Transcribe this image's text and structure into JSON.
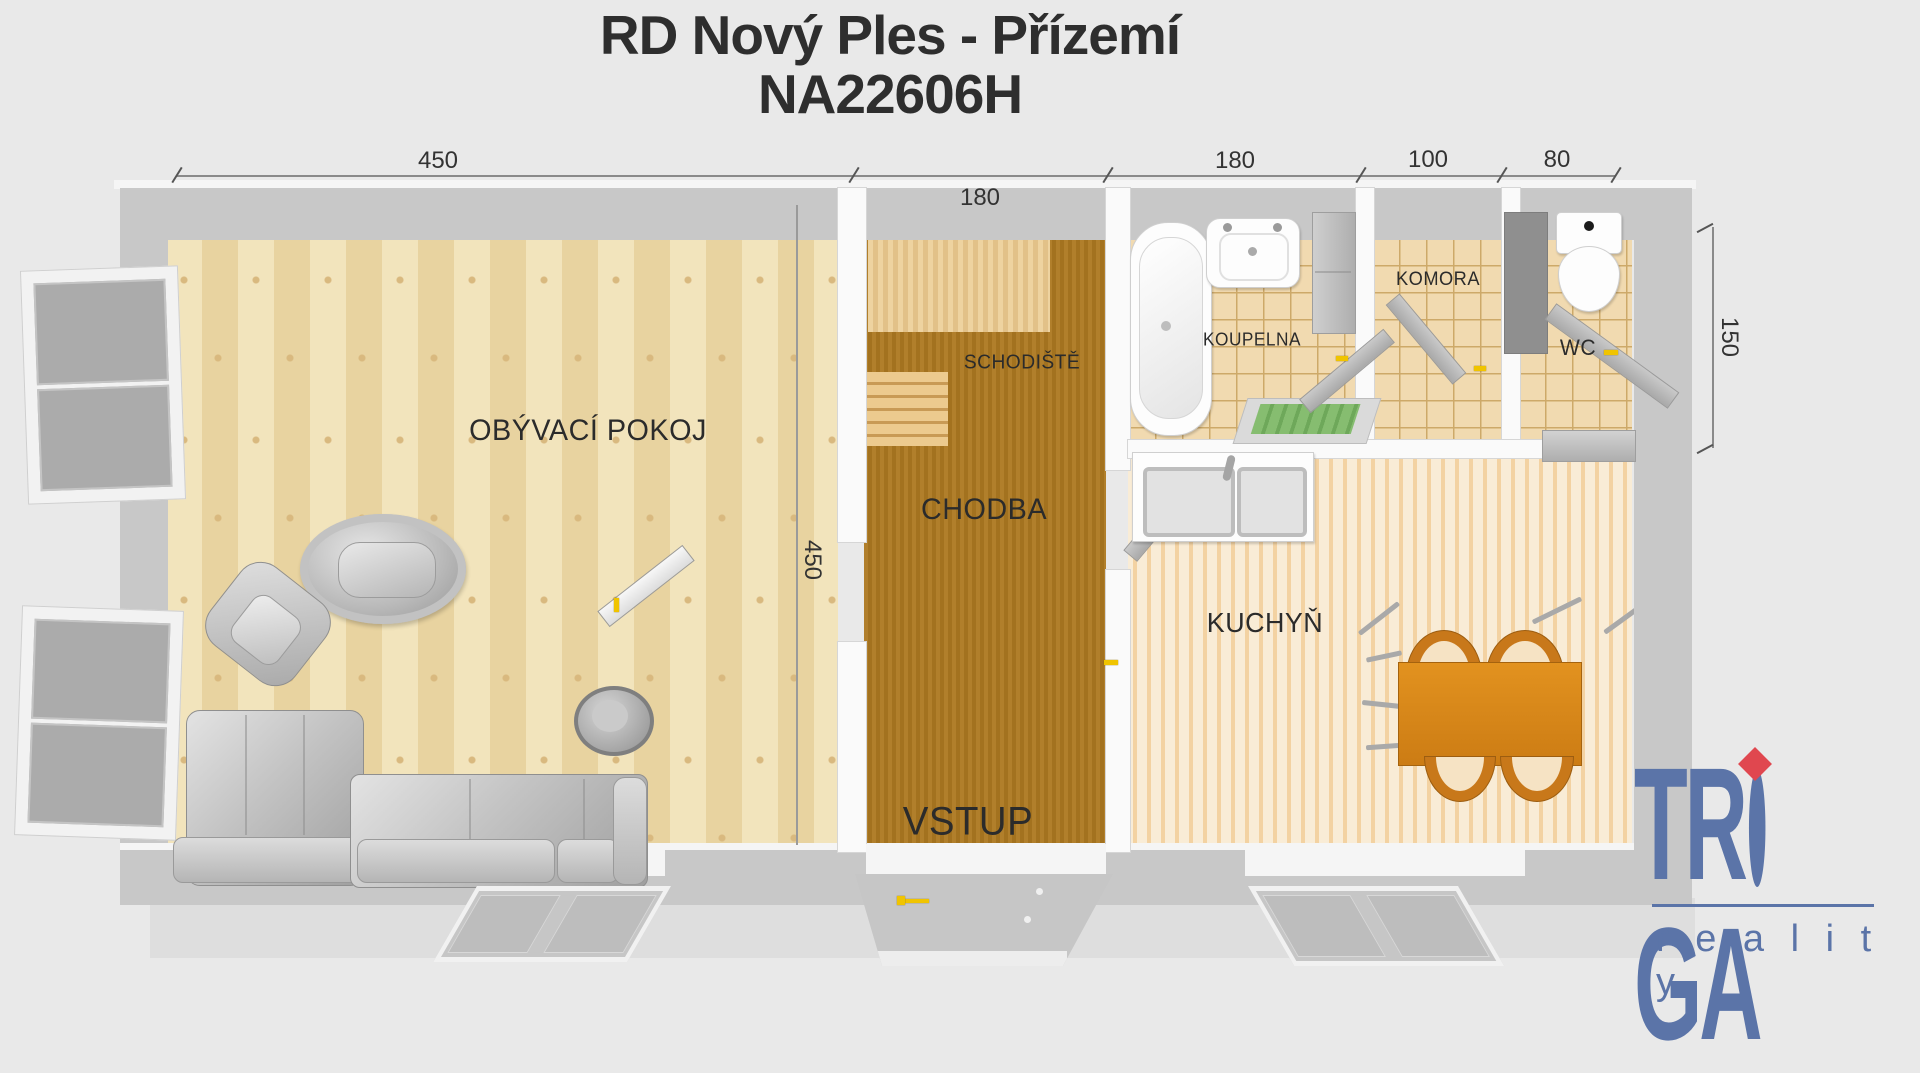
{
  "title": {
    "line1": "RD Nový Ples - Přízemí",
    "line2": "NA22606H"
  },
  "dimensions": {
    "living_width": "450",
    "hall_width": "180",
    "bath_width": "180",
    "pantry_width": "100",
    "wc_width": "80",
    "hall_depth": "450",
    "wc_depth": "150"
  },
  "rooms": {
    "living": {
      "label": "OBÝVACÍ POKOJ"
    },
    "stairs": {
      "label": "SCHODIŠTĚ"
    },
    "hall": {
      "label": "CHODBA"
    },
    "entry": {
      "label": "VSTUP"
    },
    "bathroom": {
      "label": "KOUPELNA"
    },
    "pantry": {
      "label": "KOMORA"
    },
    "wc": {
      "label": "WC"
    },
    "kitchen": {
      "label": "KUCHYŇ"
    }
  },
  "logo": {
    "brand": "TRIGA",
    "brand_left": "TR",
    "brand_right": "GA",
    "subtitle": "r e a l i t y",
    "brand_color": "#5b74a8",
    "accent_color": "#e0474f"
  },
  "colors": {
    "background": "#e9e9e9",
    "wall": "#c8c8c8",
    "living_floor": "#eedcae",
    "hall_floor": "#a87826",
    "tile_floor": "#f1dab0",
    "kitchen_floor": "#f6e3c4",
    "dining_table": "#d9851e",
    "door_handle": "#f0c400"
  }
}
